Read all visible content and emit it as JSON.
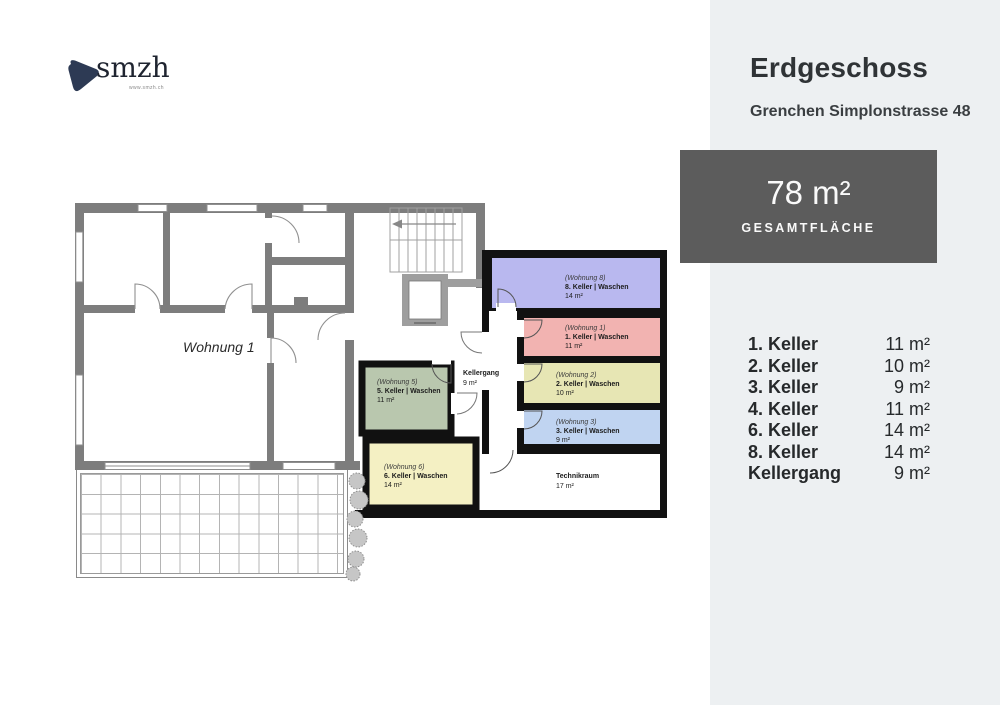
{
  "logo": {
    "name": "smzh",
    "url": "www.smzh.ch"
  },
  "header": {
    "title": "Erdgeschoss",
    "subtitle": "Grenchen Simplonstrasse 48"
  },
  "summary": {
    "value": "78 m²",
    "label": "GESAMTFLÄCHE"
  },
  "rooms_list": [
    {
      "label": "1. Keller",
      "area": "11 m²"
    },
    {
      "label": "2. Keller",
      "area": "10 m²"
    },
    {
      "label": "3. Keller",
      "area": "9 m²"
    },
    {
      "label": "4. Keller",
      "area": "11 m²"
    },
    {
      "label": "6. Keller",
      "area": "14 m²"
    },
    {
      "label": "8. Keller",
      "area": "14 m²"
    },
    {
      "label": "Kellergang",
      "area": "9 m²"
    }
  ],
  "footer": {
    "company": "smzh ag",
    "address": "Tödistrasse 53, CH-8002 Zürich",
    "email": "vermietung@smzh.ch",
    "phone": "+41 43 355 12 73"
  },
  "floorplan": {
    "apartment_label": "Wohnung 1",
    "kellergang": {
      "name": "Kellergang",
      "area": "9 m²"
    },
    "technikraum": {
      "name": "Technikraum",
      "area": "17 m²"
    },
    "cells": [
      {
        "wohnung": "(Wohnung 8)",
        "label": "8. Keller | Waschen",
        "area": "14 m²",
        "color": "#b9b8ef"
      },
      {
        "wohnung": "(Wohnung 1)",
        "label": "1. Keller | Waschen",
        "area": "11 m²",
        "color": "#f2b3b1"
      },
      {
        "wohnung": "(Wohnung 2)",
        "label": "2. Keller | Waschen",
        "area": "10 m²",
        "color": "#e7e6b4"
      },
      {
        "wohnung": "(Wohnung 3)",
        "label": "3. Keller | Waschen",
        "area": "9 m²",
        "color": "#c0d4f1"
      },
      {
        "wohnung": "(Wohnung 5)",
        "label": "5. Keller | Waschen",
        "area": "11 m²",
        "color": "#b9c7ae"
      },
      {
        "wohnung": "(Wohnung 6)",
        "label": "6. Keller | Waschen",
        "area": "14 m²",
        "color": "#f4f0c3"
      }
    ]
  },
  "colors": {
    "panel_bg": "#edf0f2",
    "box_bg": "#5c5c5c",
    "wall": "#7d7d7d",
    "logo": "#2d3a54"
  }
}
